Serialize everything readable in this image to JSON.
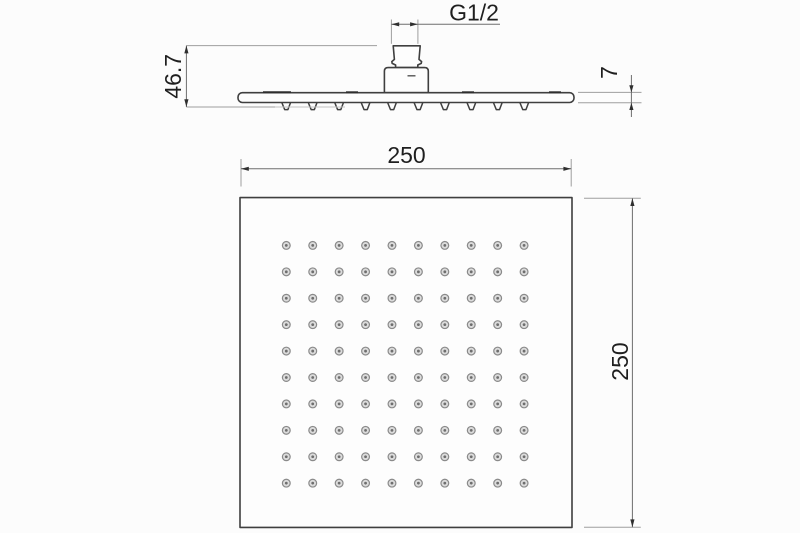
{
  "drawing": {
    "views": {
      "side_view": {
        "dimensions": {
          "thread_label": "G1/2",
          "height_label": "46.7",
          "plate_thickness_label": "7"
        }
      },
      "front_view": {
        "dimensions": {
          "width_label": "250",
          "height_label": "250"
        },
        "nozzle_grid": {
          "rows": 10,
          "cols": 10
        }
      }
    },
    "colors": {
      "outline": "#3f3f3f",
      "dimension_line": "#6e6e6e",
      "extension_line": "#9e9e9e",
      "label_text": "#1f1f1f",
      "arrow": "#2f2f2f",
      "nozzle_ring": "#8a8a8a",
      "nozzle_fill": "#dcdcdc",
      "nozzle_center": "#6e6e6e",
      "background": "#fcfcfc"
    }
  }
}
